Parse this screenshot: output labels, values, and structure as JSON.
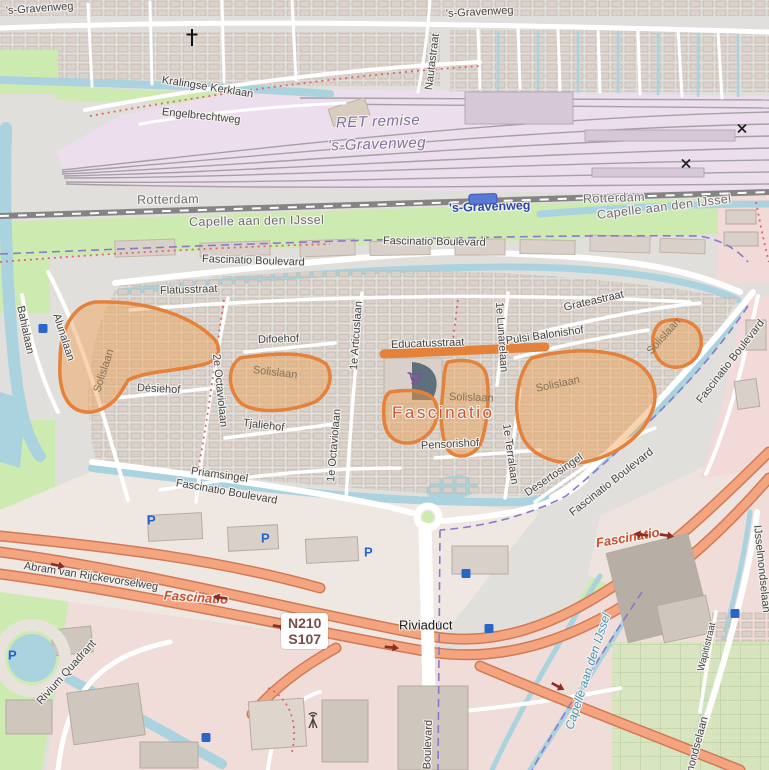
{
  "shield": {
    "line1": "N210",
    "line2": "S107"
  },
  "highlight": {
    "fill": "#f0a050",
    "stroke": "#e4813a",
    "feature": "Solislaan"
  },
  "colors": {
    "water": "#aad3df",
    "green": "#cdebb0",
    "depot": "#ecdeec",
    "trunk": "#f4a57f",
    "commercial": "#f0dcd9",
    "building": "#d9d0c9",
    "boundary": "#8a79c8",
    "station_blue": "#2b49a8",
    "highlight_label": "#cf5430"
  },
  "labels": [
    {
      "text": "'s-Gravenweg",
      "x": 6,
      "y": 11,
      "rot": -4,
      "cls": "street",
      "name": "road-label"
    },
    {
      "text": "'s-Gravenweg",
      "x": 446,
      "y": 14,
      "rot": -3,
      "cls": "street",
      "name": "road-label"
    },
    {
      "text": "Nautastraat",
      "x": 429,
      "y": 90,
      "rot": -83,
      "cls": "street",
      "name": "road-label"
    },
    {
      "text": "Kralingse Kerklaan",
      "x": 162,
      "y": 80,
      "rot": 9,
      "cls": "street",
      "name": "road-label"
    },
    {
      "text": "Engelbrechtweg",
      "x": 162,
      "y": 112,
      "rot": 6,
      "cls": "street",
      "name": "road-label"
    },
    {
      "text": "RET remise",
      "x": 336,
      "y": 123,
      "rot": -2,
      "cls": "depot",
      "name": "depot-label"
    },
    {
      "text": "'s-Gravenweg",
      "x": 328,
      "y": 146,
      "rot": -2,
      "cls": "depot",
      "name": "depot-label"
    },
    {
      "text": "Rotterdam",
      "x": 137,
      "y": 200,
      "rot": -1,
      "cls": "place",
      "name": "municipality-label"
    },
    {
      "text": "Rotterdam",
      "x": 583,
      "y": 199,
      "rot": -2,
      "cls": "place",
      "name": "municipality-label"
    },
    {
      "text": "'s-Gravenweg",
      "x": 449,
      "y": 208,
      "rot": -2,
      "cls": "station",
      "name": "station-label"
    },
    {
      "text": "Capelle aan den IJssel",
      "x": 189,
      "y": 222,
      "rot": -1,
      "cls": "place",
      "name": "municipality-label"
    },
    {
      "text": "Capelle aan den IJssel",
      "x": 597,
      "y": 215,
      "rot": -7,
      "cls": "place",
      "name": "municipality-label"
    },
    {
      "text": "Fascinatio Boulevard",
      "x": 383,
      "y": 241,
      "rot": 1,
      "cls": "street",
      "name": "road-label"
    },
    {
      "text": "Fascinatio Boulevard",
      "x": 202,
      "y": 259,
      "rot": 2,
      "cls": "street",
      "name": "road-label"
    },
    {
      "text": "Flatusstraat",
      "x": 160,
      "y": 291,
      "rot": -2,
      "cls": "street",
      "name": "road-label"
    },
    {
      "text": "Bahialaan",
      "x": 20,
      "y": 306,
      "rot": 78,
      "cls": "street",
      "name": "road-label"
    },
    {
      "text": "Alunalaan",
      "x": 56,
      "y": 314,
      "rot": 72,
      "cls": "street",
      "name": "road-label"
    },
    {
      "text": "Solislaan",
      "x": 97,
      "y": 392,
      "rot": -72,
      "cls": "patch",
      "name": "highlight-label"
    },
    {
      "text": "Désiehof",
      "x": 137,
      "y": 388,
      "rot": 3,
      "cls": "street",
      "name": "road-label"
    },
    {
      "text": "2e Octaviolaan",
      "x": 216,
      "y": 354,
      "rot": 84,
      "cls": "street",
      "name": "road-label"
    },
    {
      "text": "Difoehof",
      "x": 258,
      "y": 340,
      "rot": -2,
      "cls": "street",
      "name": "road-label"
    },
    {
      "text": "Solislaan",
      "x": 253,
      "y": 370,
      "rot": 7,
      "cls": "patch",
      "name": "highlight-label"
    },
    {
      "text": "Tjaliehof",
      "x": 243,
      "y": 423,
      "rot": 7,
      "cls": "street",
      "name": "road-label"
    },
    {
      "text": "1e Articuslaan",
      "x": 354,
      "y": 370,
      "rot": -86,
      "cls": "street",
      "name": "road-label"
    },
    {
      "text": "1e Octaviolaan",
      "x": 331,
      "y": 482,
      "rot": -85,
      "cls": "street",
      "name": "road-label"
    },
    {
      "text": "Educatusstraat",
      "x": 391,
      "y": 345,
      "rot": -2,
      "cls": "street",
      "name": "road-label"
    },
    {
      "text": "Fascinatio",
      "x": 392,
      "y": 413,
      "rot": 0,
      "cls": "suburb-big",
      "name": "suburb-label"
    },
    {
      "text": "Solislaan",
      "x": 449,
      "y": 397,
      "rot": 2,
      "cls": "patch",
      "name": "highlight-label"
    },
    {
      "text": "Pulsi Balonishof",
      "x": 506,
      "y": 341,
      "rot": -8,
      "cls": "street",
      "name": "road-label"
    },
    {
      "text": "Grateastraat",
      "x": 564,
      "y": 308,
      "rot": -13,
      "cls": "street",
      "name": "road-label"
    },
    {
      "text": "1e Lunarelaan",
      "x": 499,
      "y": 302,
      "rot": 86,
      "cls": "street",
      "name": "road-label"
    },
    {
      "text": "Solislaan",
      "x": 536,
      "y": 389,
      "rot": -12,
      "cls": "patch",
      "name": "highlight-label"
    },
    {
      "text": "Solislaan",
      "x": 649,
      "y": 353,
      "rot": -48,
      "cls": "patch",
      "name": "highlight-label"
    },
    {
      "text": "Pensorishof",
      "x": 421,
      "y": 446,
      "rot": -3,
      "cls": "street",
      "name": "road-label"
    },
    {
      "text": "1e Terralaan",
      "x": 506,
      "y": 424,
      "rot": 82,
      "cls": "street",
      "name": "road-label"
    },
    {
      "text": "Desertosingel",
      "x": 526,
      "y": 494,
      "rot": -34,
      "cls": "street",
      "name": "road-label"
    },
    {
      "text": "Priamsingel",
      "x": 191,
      "y": 471,
      "rot": 8,
      "cls": "street",
      "name": "road-label"
    },
    {
      "text": "Fascinatio Boulevard",
      "x": 176,
      "y": 483,
      "rot": 10,
      "cls": "street",
      "name": "road-label"
    },
    {
      "text": "Fascinatio Boulevard",
      "x": 571,
      "y": 514,
      "rot": -38,
      "cls": "street",
      "name": "road-label"
    },
    {
      "text": "Fascinatio Boulevard",
      "x": 699,
      "y": 402,
      "rot": -52,
      "cls": "street",
      "name": "road-label"
    },
    {
      "text": "Abram van Rijckevorselweg",
      "x": 24,
      "y": 566,
      "rot": 9,
      "cls": "street",
      "name": "road-label"
    },
    {
      "text": "Fascinatio",
      "x": 164,
      "y": 595,
      "rot": 4,
      "cls": "suburb-it",
      "name": "suburb-label"
    },
    {
      "text": "Fascinatio",
      "x": 596,
      "y": 543,
      "rot": -10,
      "cls": "suburb-it",
      "name": "suburb-label"
    },
    {
      "text": "Riviaduct",
      "x": 399,
      "y": 625,
      "rot": 0,
      "cls": "road-black",
      "name": "bridge-label"
    },
    {
      "text": "Rivium Quadrant",
      "x": 39,
      "y": 703,
      "rot": -48,
      "cls": "street",
      "name": "road-label"
    },
    {
      "text": "Capelle aan den IJssel",
      "x": 569,
      "y": 729,
      "rot": -72,
      "cls": "water",
      "name": "boundary-label"
    },
    {
      "text": "IJsselmondselaan",
      "x": 757,
      "y": 525,
      "rot": 84,
      "cls": "street",
      "name": "road-label"
    },
    {
      "text": "IJsselmondselaan",
      "x": 682,
      "y": 802,
      "rot": -75,
      "cls": "street",
      "name": "road-label"
    },
    {
      "text": "Wapitistraat",
      "x": 701,
      "y": 671,
      "rot": -76,
      "cls": "street-sm",
      "name": "road-label"
    },
    {
      "text": "Rivium Boulevard",
      "x": 426,
      "y": 806,
      "rot": -88,
      "cls": "street",
      "name": "road-label"
    },
    {
      "text": "P",
      "x": 147,
      "y": 520,
      "rot": 0,
      "cls": "parking",
      "name": "parking-icon"
    },
    {
      "text": "P",
      "x": 261,
      "y": 538,
      "rot": 0,
      "cls": "parking",
      "name": "parking-icon"
    },
    {
      "text": "P",
      "x": 364,
      "y": 552,
      "rot": 0,
      "cls": "parking",
      "name": "parking-icon"
    },
    {
      "text": "P",
      "x": 8,
      "y": 655,
      "rot": 0,
      "cls": "parking",
      "name": "parking-icon"
    }
  ],
  "icons": [
    {
      "name": "church-icon",
      "x": 192,
      "y": 40,
      "rot": 0
    },
    {
      "name": "supermarket-icon",
      "x": 415,
      "y": 381,
      "rot": 0
    },
    {
      "name": "antenna-icon",
      "x": 313,
      "y": 723,
      "rot": 0
    },
    {
      "name": "station-icon",
      "x": 483,
      "y": 201,
      "rot": -2
    },
    {
      "name": "bus-stop-icon",
      "x": 43,
      "y": 329,
      "rot": 0
    },
    {
      "name": "bus-stop-icon",
      "x": 466,
      "y": 574,
      "rot": 0
    },
    {
      "name": "bus-stop-icon",
      "x": 489,
      "y": 629,
      "rot": 0
    },
    {
      "name": "bus-stop-icon",
      "x": 735,
      "y": 614,
      "rot": 0
    },
    {
      "name": "bus-stop-icon",
      "x": 206,
      "y": 738,
      "rot": 0
    },
    {
      "name": "crossing-icon",
      "x": 742,
      "y": 130,
      "rot": 0
    },
    {
      "name": "crossing-icon",
      "x": 686,
      "y": 165,
      "rot": 0
    },
    {
      "name": "oneway-arrow-icon",
      "x": 58,
      "y": 566,
      "rot": 12
    },
    {
      "name": "oneway-arrow-icon",
      "x": 220,
      "y": 597,
      "rot": 188
    },
    {
      "name": "oneway-arrow-icon",
      "x": 280,
      "y": 627,
      "rot": 8
    },
    {
      "name": "oneway-arrow-icon",
      "x": 392,
      "y": 648,
      "rot": 6
    },
    {
      "name": "oneway-arrow-icon",
      "x": 641,
      "y": 534,
      "rot": 188
    },
    {
      "name": "oneway-arrow-icon",
      "x": 667,
      "y": 536,
      "rot": 8
    },
    {
      "name": "oneway-arrow-icon",
      "x": 558,
      "y": 687,
      "rot": 28
    }
  ]
}
